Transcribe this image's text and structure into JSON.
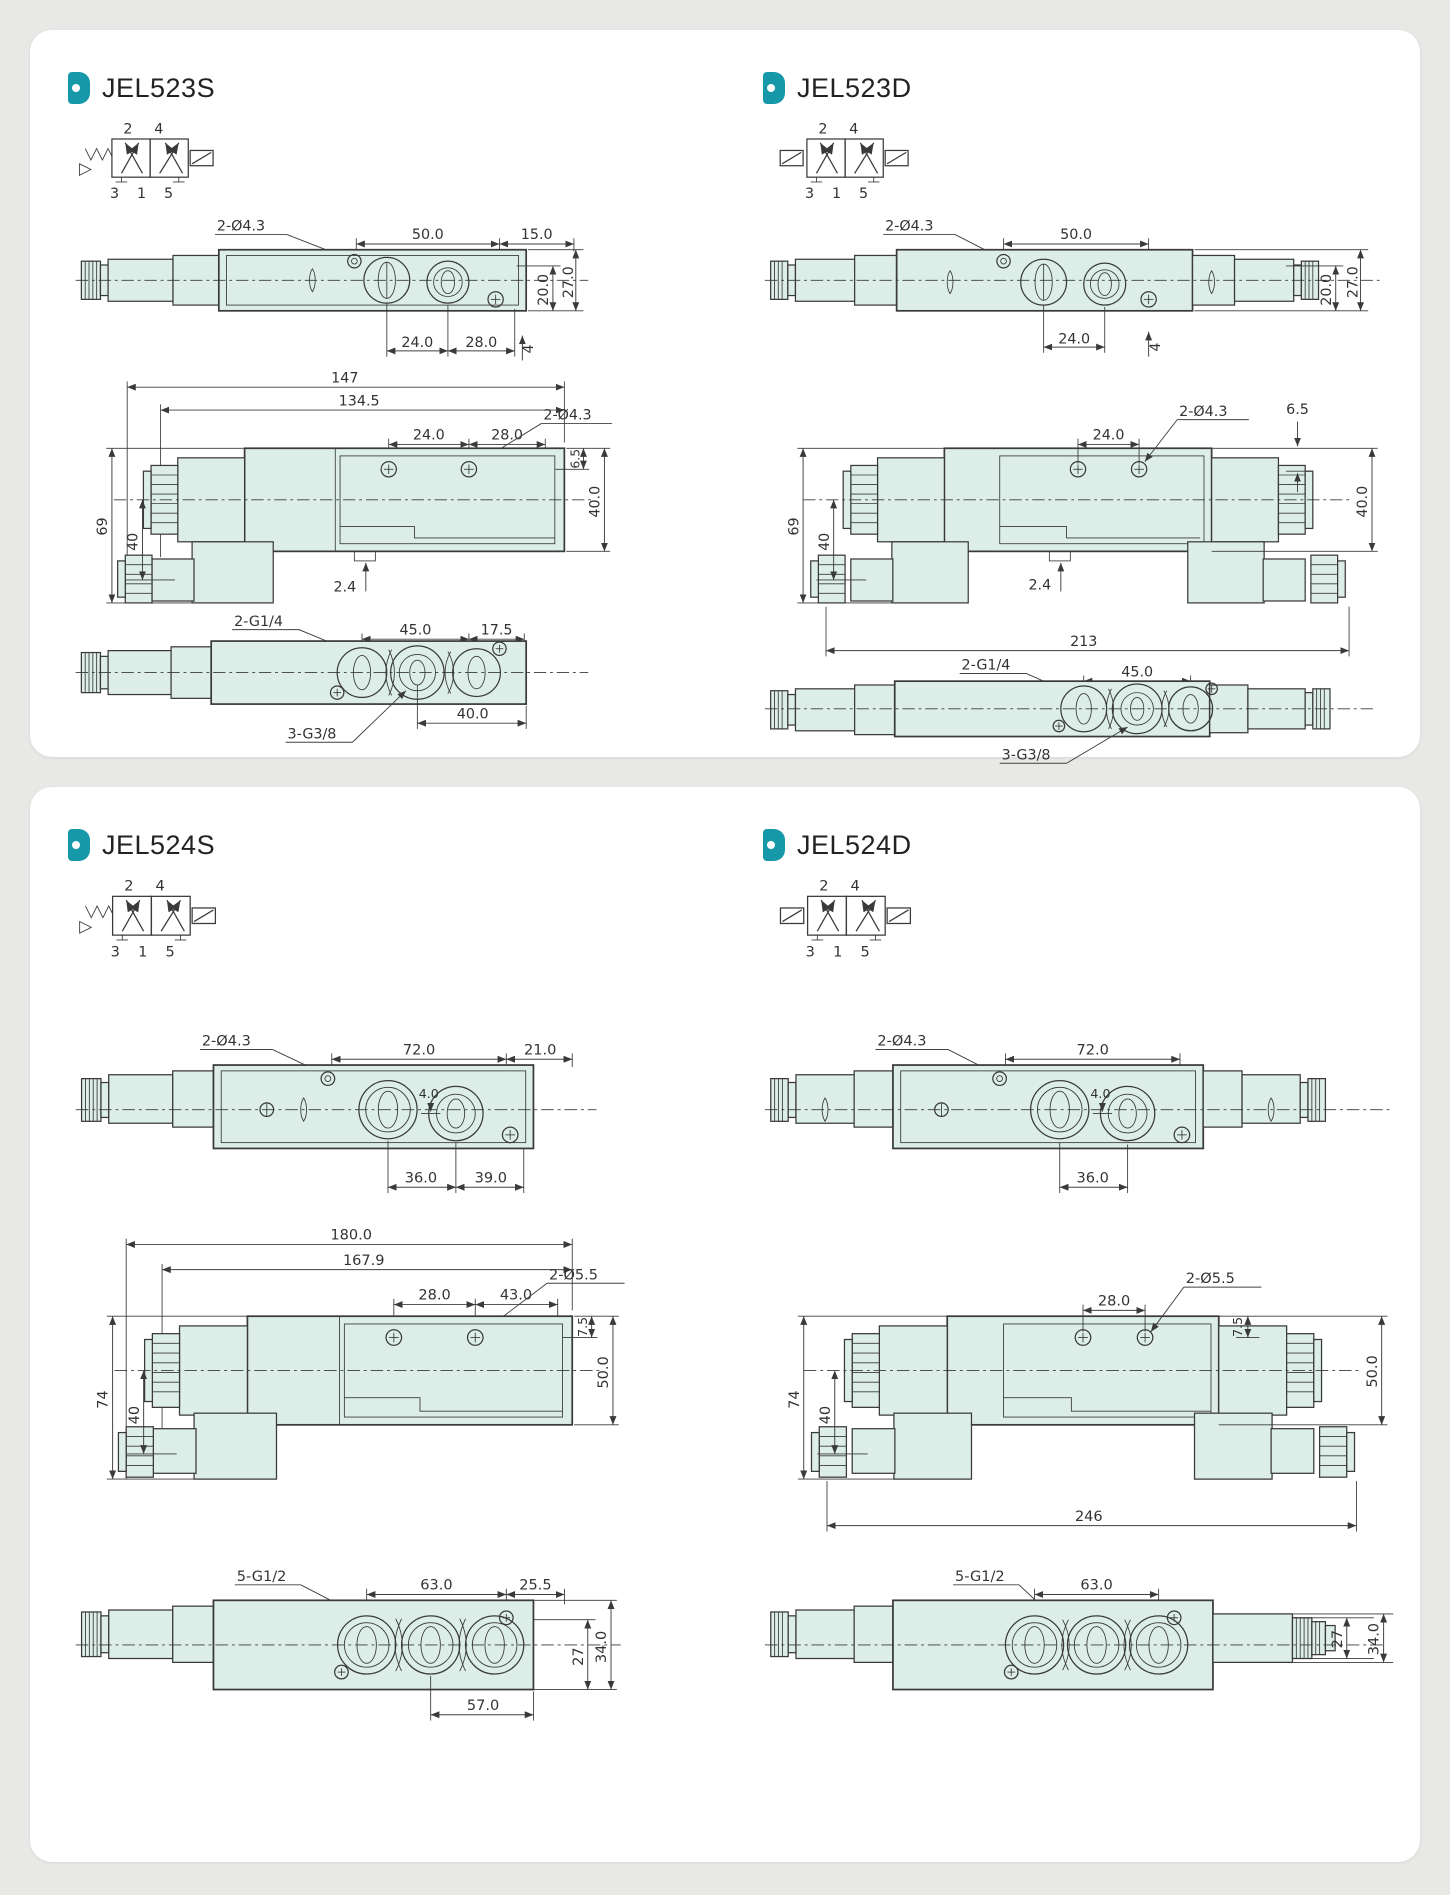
{
  "page": {
    "bg": "#e8e8e6",
    "card_bg": "#ffffff",
    "accent": "#1798a8",
    "line": "#3a3a3a",
    "body_fill": "#ddeee8"
  },
  "jel523s": {
    "title": "JEL523S",
    "symbol": {
      "top": "2 4",
      "bottom": "3 1 5"
    },
    "top": {
      "hole": "2-Ø4.3",
      "w1": "50.0",
      "w2": "15.0",
      "h1": "20.0",
      "h2": "27.0",
      "b1": "24.0",
      "b2": "28.0",
      "b3": "4"
    },
    "front": {
      "w1": "147",
      "w2": "134.5",
      "s1": "24.0",
      "s2": "28.0",
      "hole": "2-Ø4.3",
      "o1": "6.5",
      "o2": "40.0",
      "l1": "69",
      "l2": "40",
      "p": "2.4"
    },
    "bottom": {
      "ports": "2-G1/4",
      "p1": "45.0",
      "p2": "17.5",
      "center": "3-G3/8",
      "r1": "40.0"
    }
  },
  "jel523d": {
    "title": "JEL523D",
    "symbol": {
      "top": "2 4",
      "bottom": "3 1 5"
    },
    "top": {
      "hole": "2-Ø4.3",
      "w1": "50.0",
      "h1": "20.0",
      "h2": "27.0",
      "b1": "24.0",
      "b3": "4"
    },
    "front": {
      "s1": "24.0",
      "hole": "2-Ø4.3",
      "o1": "6.5",
      "o2": "40.0",
      "l1": "69",
      "l2": "40",
      "p": "2.4",
      "ow": "213"
    },
    "bottom": {
      "ports": "2-G1/4",
      "p1": "45.0",
      "center": "3-G3/8"
    }
  },
  "jel524s": {
    "title": "JEL524S",
    "symbol": {
      "top": "2 4",
      "bottom": "3 1 5"
    },
    "top": {
      "hole": "2-Ø4.3",
      "w1": "72.0",
      "w2": "21.0",
      "inner": "4.0",
      "b1": "36.0",
      "b2": "39.0"
    },
    "front": {
      "w1": "180.0",
      "w2": "167.9",
      "s1": "28.0",
      "s2": "43.0",
      "hole": "2-Ø5.5",
      "o1": "7.5",
      "o2": "50.0",
      "l1": "74",
      "l2": "40"
    },
    "bottom": {
      "ports": "5-G1/2",
      "p1": "63.0",
      "p2": "25.5",
      "r1": "27",
      "r2": "34.0",
      "b1": "57.0"
    }
  },
  "jel524d": {
    "title": "JEL524D",
    "symbol": {
      "top": "2 4",
      "bottom": "3 1 5"
    },
    "top": {
      "hole": "2-Ø4.3",
      "w1": "72.0",
      "inner": "4.0",
      "b1": "36.0"
    },
    "front": {
      "s1": "28.0",
      "hole": "2-Ø5.5",
      "o1": "7.5",
      "o2": "50.0",
      "l1": "74",
      "l2": "40",
      "ow": "246"
    },
    "bottom": {
      "ports": "5-G1/2",
      "p1": "63.0",
      "r1": "27",
      "r2": "34.0"
    }
  }
}
